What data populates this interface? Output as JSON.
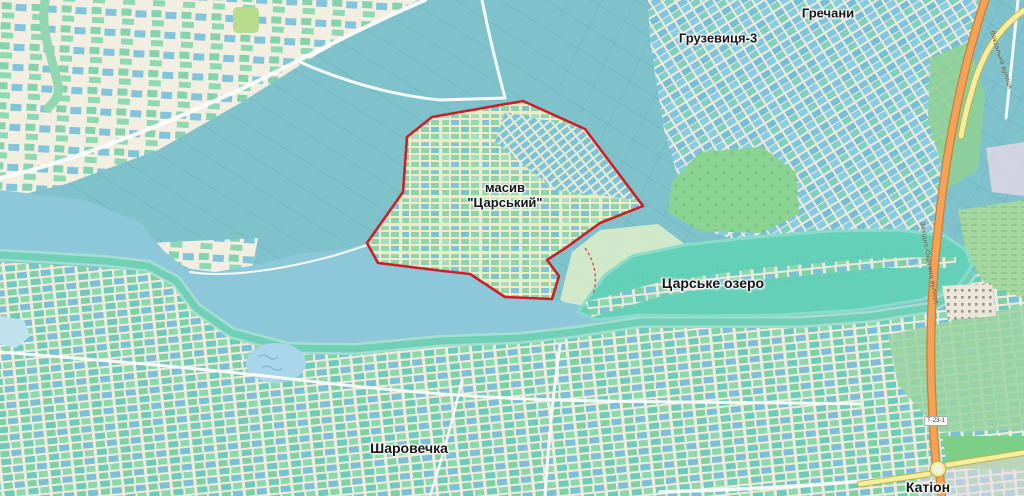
{
  "map": {
    "title": "Map of masyv Tsarskyi area",
    "labels": {
      "grechany": "Гречани",
      "gruzevytsia": "Грузевиця-3",
      "masyv_line1": "масив",
      "masyv_line2": "\"Царський\"",
      "lake": "Царське озеро",
      "sharovechka": "Шаровечка",
      "kation": "Катіон",
      "ring_road": "Західно-Окружна вулиця",
      "vokzalna_street": "Вокзальна вулиця",
      "road_ref": "Т-23-1"
    },
    "features": {
      "highlighted_area": "масив \"Царський\" (red boundary)",
      "water_body": "Царське озеро"
    },
    "colors": {
      "farmland": "#7fc2cb",
      "river_water": "#8cc8da",
      "lake_water": "#65d0b8",
      "shore_band": "#6fd0b6",
      "residential_cream": "#f0ecdb",
      "plot_green": "#8fd2ae",
      "plot_blue": "#7fc3dc",
      "orchard_green": "#8ad392",
      "boundary_red": "#cc1f26",
      "road_trunk_orange": "#f4a159",
      "road_yellow": "#f6ee9f"
    }
  }
}
